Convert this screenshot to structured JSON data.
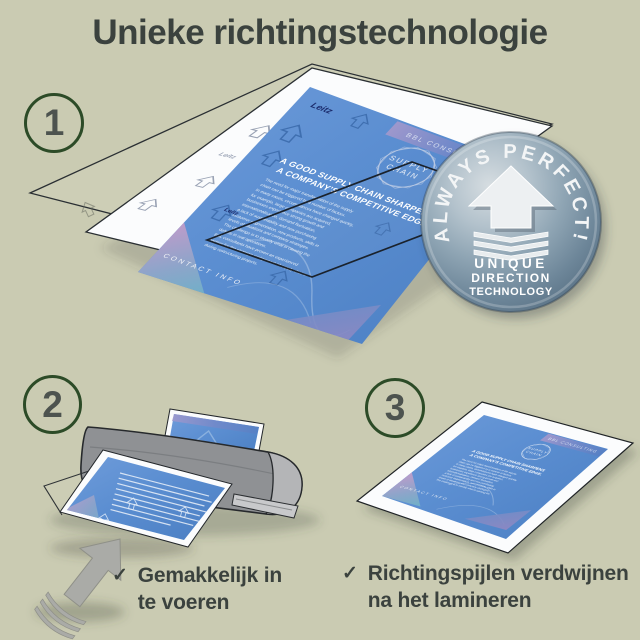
{
  "title": "Unieke richtingstechnologie",
  "steps": [
    {
      "number": "1"
    },
    {
      "number": "2"
    },
    {
      "number": "3"
    }
  ],
  "badge": {
    "arc_text": "ALWAYS PERFECT!",
    "line1": "UNIQUE",
    "line2": "DIRECTION",
    "line3": "TECHNOLOGY",
    "icon": "up-arrow-with-chevrons"
  },
  "doc": {
    "brand": "Leitz",
    "band_top": "BBL CONSULTING",
    "logo_line1": "SUPPLY",
    "logo_line2": "CHAIN",
    "heading_line1": "A GOOD SUPPLY CHAIN SHARPENS",
    "heading_line2": "A COMPANY'S COMPETITIVE EDGE.",
    "body_lines": [
      "The need for major transformation of the supply",
      "chain can be triggered by a number of factors.",
      "In many cases, circumstances have changed quickly,",
      "for example, large companies are acquired,",
      "businesses experience strong growth and",
      "internationalisation, demand fluctuation,",
      "a lack of sustainability and new purchasing",
      "customer segmentation, new products, skills in",
      "levels of situations and company strategies.",
      "The challenge is to identify what is causing the",
      "deficits in real operations.",
      "BBL consultants have proven an experienced",
      "partner for the strategic realignment of supply chains",
      "during restructuring projects."
    ],
    "footer": "CONTACT INFO"
  },
  "notes": [
    {
      "check": "✓",
      "line1": "Gemakkelijk in",
      "line2": "te voeren"
    },
    {
      "check": "✓",
      "line1": "Richtingspijlen verdwijnen",
      "line2": "na het lamineren"
    }
  ],
  "colors": {
    "background": "#cacbb2",
    "text_dark": "#3b423e",
    "ring_green": "#2c4b27",
    "doc_blue": "#5b8ed1",
    "badge_steel": "#8fa5b4",
    "laminator_gray": "#8f9194"
  }
}
